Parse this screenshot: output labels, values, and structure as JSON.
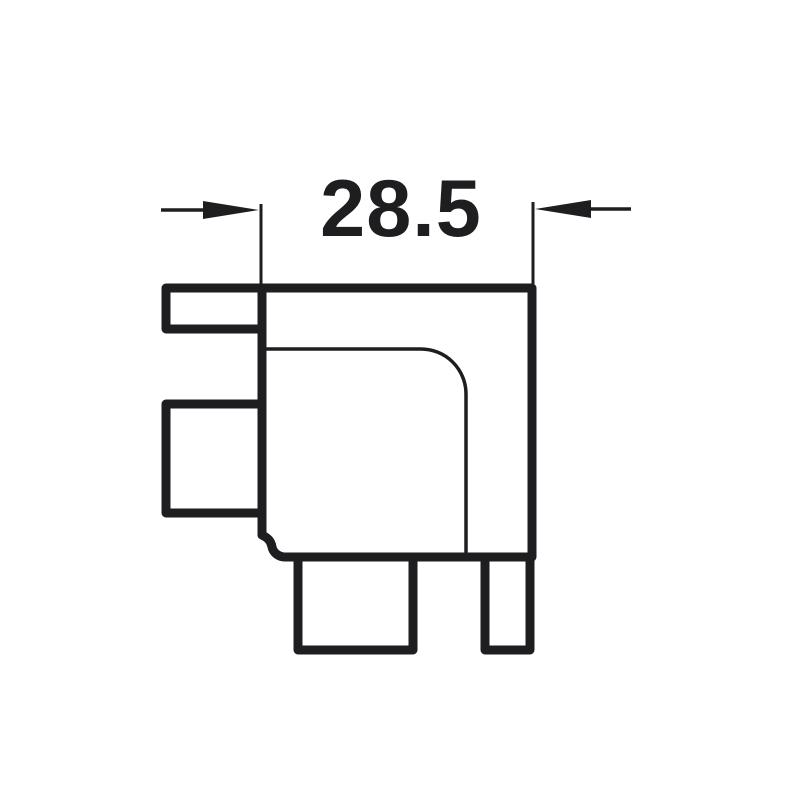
{
  "drawing": {
    "dimension_label": "28.5",
    "line_color": "#1e1e21",
    "background_color": "#ffffff"
  }
}
